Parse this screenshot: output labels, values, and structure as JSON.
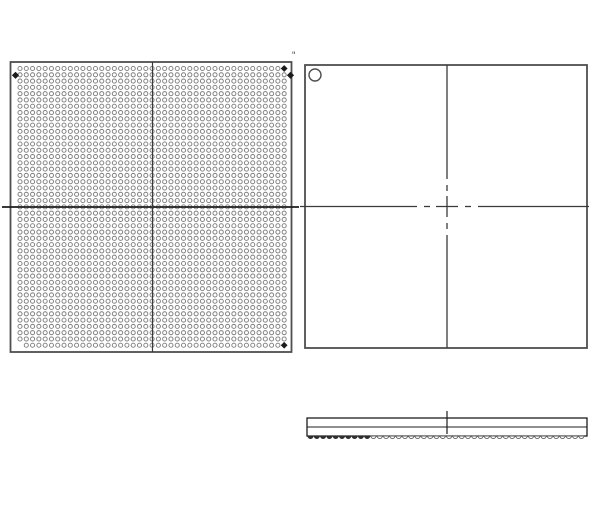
{
  "page": {
    "width": 600,
    "height": 525,
    "background": "#ffffff"
  },
  "colors": {
    "frame": "#4f4f4f",
    "ball_stroke": "#7e7e7e",
    "marker_fill": "#1c1c1c",
    "centerline_dark": "#1d1d1d",
    "centerline": "#3a3a3a",
    "side_ball_fill": "#2e2e2e"
  },
  "bottom_view": {
    "title": "ball-grid-bottom-view",
    "frame": {
      "x": 10.5,
      "y": 62,
      "w": 281,
      "h": 290
    },
    "grid": {
      "cols": 43,
      "rows": 45,
      "start_x": 20,
      "start_y": 68.5,
      "pitch": 6.29,
      "radius": 2.05
    },
    "missing_cells": [
      {
        "row": 45,
        "col": 1
      }
    ],
    "diamond_cells": [
      {
        "row": 1,
        "col": 43
      },
      {
        "row": 45,
        "col": 43
      }
    ],
    "edge_diamonds": [
      {
        "x": 15.5,
        "y": 75.3
      },
      {
        "x": 290.5,
        "y": 75.3
      }
    ],
    "corner_mark": {
      "text": "\""
    },
    "centerline_h": {
      "y": 207,
      "x1": 2,
      "x2": 299
    },
    "centerline_v": {
      "x": 152.5,
      "y1": 62,
      "y2": 352
    }
  },
  "top_view": {
    "title": "package-top-view",
    "frame": {
      "x": 305,
      "y": 65,
      "w": 282,
      "h": 283
    },
    "pin1_circle": {
      "cx": 315,
      "cy": 75,
      "r": 6
    },
    "centerline_v": {
      "x": 447,
      "segments": [
        [
          65,
          179
        ],
        [
          185,
          191
        ],
        [
          196,
          217
        ],
        [
          223,
          229
        ],
        [
          235,
          348
        ]
      ]
    },
    "centerline_h": {
      "y": 206.5,
      "segments": [
        [
          300,
          417
        ],
        [
          424,
          430
        ],
        [
          436,
          458
        ],
        [
          465,
          471
        ],
        [
          478,
          589
        ]
      ]
    }
  },
  "side_view": {
    "title": "package-side-view",
    "body": {
      "x": 307,
      "y": 418,
      "w": 280,
      "h": 18
    },
    "seating_line_y": 427,
    "balls": {
      "count": 44,
      "start_x": 310.5,
      "pitch": 6.3,
      "radius": 2.6,
      "y": 436,
      "filled_count": 10
    },
    "center_tick": {
      "x": 447,
      "y1": 411,
      "y2": 434
    }
  }
}
